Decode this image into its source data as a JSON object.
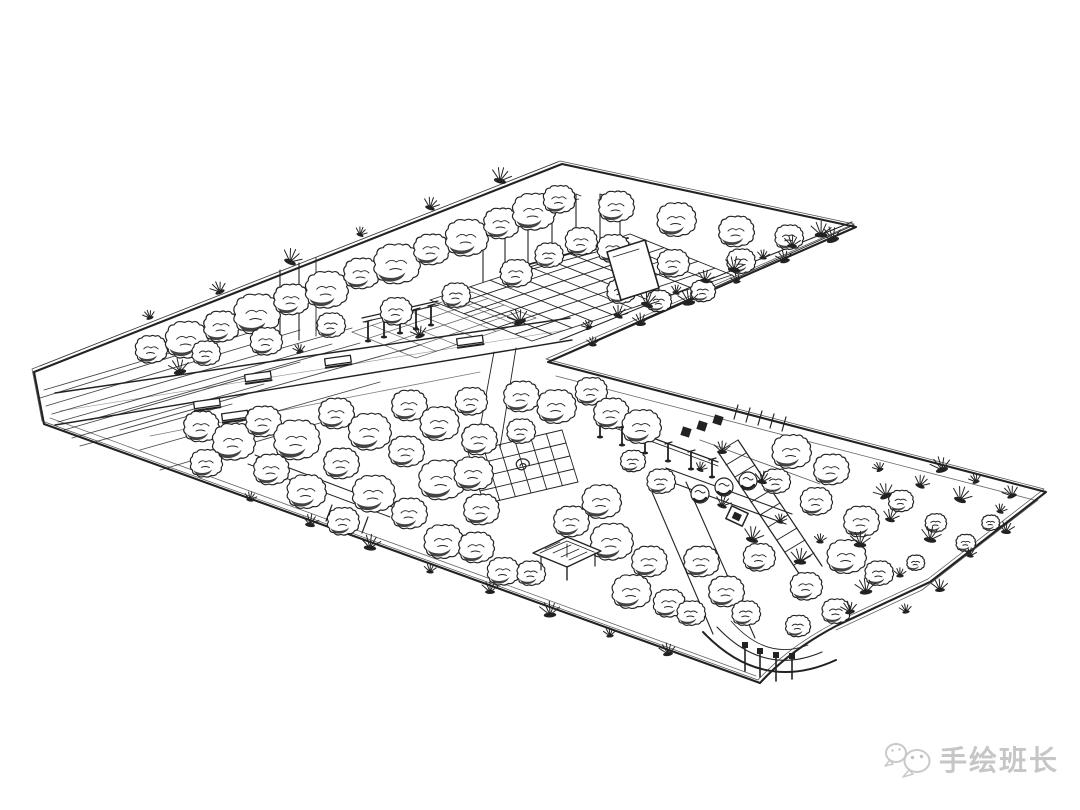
{
  "meta": {
    "title": "Hand-drawn landscape architecture aerial perspective sketch",
    "medium": "pen and ink on white paper"
  },
  "watermark": {
    "text": "手绘班长",
    "icon": "wechat-icon",
    "color": "#c6c6c6"
  },
  "colors": {
    "ink": "#222222",
    "paper": "#ffffff",
    "light": "#555555",
    "watermark": "#c6c6c6"
  },
  "sketch": {
    "boundary": {
      "d": "M34,372 L562,164 L856,227 L548,362 L1046,492 L930,582 L838,625 Q790,650 760,683 L44,424 Z",
      "offset": [
        -2,
        -3
      ]
    },
    "hatch": [
      [
        40,
        398,
        258,
        330
      ],
      [
        46,
        406,
        300,
        330
      ],
      [
        52,
        414,
        352,
        328
      ],
      [
        58,
        422,
        332,
        344
      ],
      [
        64,
        430,
        300,
        362
      ],
      [
        72,
        438,
        264,
        384
      ],
      [
        80,
        446,
        232,
        404
      ],
      [
        44,
        390,
        180,
        350
      ],
      [
        120,
        430,
        420,
        345
      ],
      [
        140,
        450,
        380,
        382
      ],
      [
        90,
        420,
        360,
        343
      ],
      [
        160,
        470,
        330,
        420
      ]
    ],
    "lines": [
      [
        55,
        393,
        570,
        318,
        1.4
      ],
      [
        55,
        425,
        572,
        340,
        1.4
      ],
      [
        60,
        411,
        566,
        330,
        0.6,
        0.5
      ],
      [
        150,
        436,
        480,
        372,
        0.8,
        0.6
      ],
      [
        560,
        340,
        852,
        222,
        1.1
      ],
      [
        570,
        352,
        854,
        225,
        0.9
      ],
      [
        556,
        376,
        1034,
        500,
        0.8,
        0.7
      ],
      [
        1038,
        500,
        922,
        590,
        0.8,
        0.7
      ],
      [
        922,
        590,
        836,
        630,
        0.8,
        0.7
      ],
      [
        50,
        418,
        756,
        676,
        0.8,
        0.7
      ],
      [
        40,
        366,
        558,
        162,
        0.7,
        0.6
      ],
      [
        255,
        455,
        395,
        508,
        1
      ],
      [
        248,
        464,
        390,
        517,
        1
      ],
      [
        332,
        505,
        326,
        521,
        1.2
      ],
      [
        344,
        509,
        338,
        525,
        1.2
      ],
      [
        356,
        513,
        350,
        529,
        1.2
      ],
      [
        368,
        517,
        362,
        533,
        1.2
      ],
      [
        494,
        352,
        476,
        450,
        0.9
      ],
      [
        516,
        348,
        500,
        448,
        0.9
      ],
      [
        652,
        492,
        713,
        634,
        1.1
      ],
      [
        686,
        482,
        755,
        638,
        1.1
      ],
      [
        596,
        417,
        718,
        462,
        1.3
      ],
      [
        596,
        421,
        718,
        466,
        0.9
      ],
      [
        666,
        468,
        792,
        514,
        1.1
      ],
      [
        660,
        478,
        786,
        524,
        1.1
      ],
      [
        700,
        440,
        820,
        484,
        0.9,
        0.7
      ],
      [
        718,
        452,
        802,
        578,
        1.2
      ],
      [
        738,
        440,
        822,
        566,
        1.2
      ],
      [
        718,
        452,
        738,
        440,
        1
      ],
      [
        726,
        465,
        746,
        453,
        1
      ],
      [
        735,
        477,
        755,
        465,
        1
      ],
      [
        743,
        490,
        763,
        478,
        1
      ],
      [
        751,
        502,
        771,
        490,
        1
      ],
      [
        760,
        515,
        780,
        503,
        1
      ],
      [
        768,
        527,
        788,
        515,
        1
      ],
      [
        777,
        540,
        797,
        528,
        1
      ],
      [
        785,
        552,
        805,
        540,
        1
      ],
      [
        794,
        565,
        814,
        553,
        1
      ],
      [
        738,
        405,
        734,
        419,
        1.2
      ],
      [
        750,
        408,
        746,
        422,
        1.2
      ],
      [
        762,
        411,
        758,
        425,
        1.2
      ],
      [
        774,
        414,
        770,
        428,
        1.2
      ],
      [
        786,
        417,
        782,
        431,
        1.2
      ],
      [
        362,
        318,
        438,
        301,
        1.2
      ],
      [
        363,
        322,
        439,
        305,
        0.9
      ],
      [
        280,
        270,
        280,
        345,
        1.1
      ],
      [
        299,
        263,
        299,
        340,
        1.1
      ],
      [
        316,
        258,
        316,
        336,
        0.9
      ],
      [
        500,
        272,
        628,
        238,
        1.8
      ],
      [
        502,
        277,
        630,
        243,
        0.9
      ]
    ],
    "grids": [
      {
        "o": [
          430,
          300
        ],
        "u": [
          200,
          -66
        ],
        "v": [
          102,
          41
        ],
        "nu": 10,
        "nv": 6,
        "w": 0.9,
        "op": 1
      },
      {
        "o": [
          352,
          332
        ],
        "u": [
          120,
          -40
        ],
        "v": [
          64,
          26
        ],
        "nu": 6,
        "nv": 4,
        "w": 0.7,
        "op": 0.7
      },
      {
        "o": [
          468,
          452
        ],
        "u": [
          94,
          -22
        ],
        "v": [
          16,
          52
        ],
        "nu": 6,
        "nv": 4,
        "w": 0.9,
        "op": 1
      }
    ],
    "poles": [
      [
        483,
        282,
        50
      ],
      [
        505,
        275,
        54
      ],
      [
        528,
        268,
        60
      ],
      [
        552,
        260,
        62
      ],
      [
        576,
        252,
        58
      ],
      [
        600,
        244,
        50
      ],
      [
        620,
        237,
        44
      ]
    ],
    "columns": [
      [
        600,
        436,
        16
      ],
      [
        622,
        444,
        16
      ],
      [
        645,
        452,
        16
      ],
      [
        668,
        460,
        16
      ],
      [
        691,
        468,
        16
      ],
      [
        712,
        476,
        16
      ],
      [
        368,
        340,
        18
      ],
      [
        384,
        336,
        18
      ],
      [
        400,
        332,
        18
      ],
      [
        416,
        328,
        18
      ],
      [
        431,
        324,
        18
      ]
    ],
    "benches": [
      [
        258,
        377,
        -8
      ],
      [
        338,
        361,
        -8
      ],
      [
        470,
        341,
        -8
      ],
      [
        207,
        404,
        -8
      ],
      [
        235,
        416,
        -8
      ]
    ],
    "squares": [
      [
        686,
        432,
        9
      ],
      [
        702,
        426,
        9
      ],
      [
        718,
        420,
        9
      ]
    ],
    "bowls": [
      [
        700,
        494
      ],
      [
        724,
        487
      ],
      [
        748,
        481
      ]
    ],
    "feature_square": [
      [
        737,
        516
      ]
    ],
    "trees": [
      [
        150,
        348,
        0.9
      ],
      [
        185,
        338,
        1.2
      ],
      [
        220,
        325,
        1.0
      ],
      [
        255,
        312,
        1.3
      ],
      [
        290,
        298,
        1.0
      ],
      [
        325,
        288,
        1.2
      ],
      [
        360,
        272,
        1.0
      ],
      [
        395,
        262,
        1.3
      ],
      [
        430,
        248,
        1.0
      ],
      [
        465,
        236,
        1.2
      ],
      [
        500,
        222,
        1.0
      ],
      [
        532,
        210,
        1.2
      ],
      [
        558,
        198,
        0.9
      ],
      [
        205,
        352,
        0.8
      ],
      [
        265,
        340,
        0.9
      ],
      [
        330,
        324,
        0.8
      ],
      [
        395,
        310,
        0.9
      ],
      [
        455,
        294,
        0.8
      ],
      [
        515,
        272,
        0.9
      ],
      [
        548,
        254,
        0.8
      ],
      [
        580,
        240,
        0.9
      ],
      [
        615,
        205,
        1.0
      ],
      [
        612,
        247,
        0.9
      ],
      [
        620,
        290,
        0.8
      ],
      [
        675,
        218,
        1.1
      ],
      [
        672,
        262,
        0.9
      ],
      [
        735,
        230,
        1.0
      ],
      [
        740,
        260,
        0.8
      ],
      [
        788,
        236,
        0.8
      ],
      [
        658,
        300,
        0.7
      ],
      [
        702,
        290,
        0.7
      ],
      [
        200,
        425,
        1.0
      ],
      [
        232,
        440,
        1.2
      ],
      [
        205,
        462,
        0.9
      ],
      [
        262,
        420,
        1.0
      ],
      [
        295,
        438,
        1.3
      ],
      [
        270,
        468,
        1.0
      ],
      [
        305,
        490,
        1.1
      ],
      [
        335,
        412,
        1.0
      ],
      [
        368,
        430,
        1.2
      ],
      [
        340,
        462,
        1.0
      ],
      [
        372,
        492,
        1.2
      ],
      [
        342,
        520,
        0.9
      ],
      [
        408,
        404,
        1.0
      ],
      [
        438,
        422,
        1.1
      ],
      [
        405,
        450,
        1.0
      ],
      [
        440,
        478,
        1.3
      ],
      [
        408,
        512,
        1.0
      ],
      [
        442,
        540,
        1.1
      ],
      [
        470,
        400,
        0.9
      ],
      [
        478,
        438,
        1.0
      ],
      [
        472,
        472,
        1.1
      ],
      [
        480,
        508,
        1.0
      ],
      [
        475,
        546,
        1.0
      ],
      [
        502,
        570,
        0.9
      ],
      [
        520,
        395,
        1.0
      ],
      [
        555,
        405,
        1.1
      ],
      [
        590,
        390,
        0.9
      ],
      [
        520,
        430,
        0.8
      ],
      [
        610,
        412,
        1.0
      ],
      [
        640,
        425,
        1.1
      ],
      [
        600,
        500,
        1.1
      ],
      [
        570,
        520,
        1.0
      ],
      [
        530,
        572,
        0.8
      ],
      [
        610,
        540,
        1.2
      ],
      [
        648,
        560,
        1.0
      ],
      [
        630,
        590,
        1.1
      ],
      [
        668,
        602,
        0.9
      ],
      [
        700,
        560,
        1.0
      ],
      [
        690,
        612,
        0.8
      ],
      [
        725,
        590,
        1.0
      ],
      [
        660,
        480,
        0.8
      ],
      [
        632,
        460,
        0.7
      ],
      [
        758,
        556,
        0.9
      ],
      [
        745,
        612,
        0.8
      ],
      [
        790,
        450,
        1.1
      ],
      [
        830,
        468,
        1.0
      ],
      [
        815,
        500,
        0.9
      ],
      [
        860,
        520,
        1.0
      ],
      [
        845,
        555,
        1.1
      ],
      [
        878,
        572,
        0.8
      ],
      [
        805,
        585,
        0.9
      ],
      [
        835,
        610,
        0.8
      ],
      [
        797,
        625,
        0.7
      ],
      [
        775,
        480,
        0.8
      ],
      [
        900,
        500,
        0.7
      ],
      [
        935,
        522,
        0.6
      ],
      [
        965,
        542,
        0.55
      ],
      [
        915,
        562,
        0.5
      ],
      [
        990,
        522,
        0.5
      ]
    ],
    "tufts": [
      [
        589,
        328
      ],
      [
        618,
        316
      ],
      [
        647,
        305
      ],
      [
        676,
        293
      ],
      [
        705,
        281
      ],
      [
        734,
        270
      ],
      [
        763,
        258
      ],
      [
        792,
        246
      ],
      [
        821,
        235
      ],
      [
        593,
        345
      ],
      [
        641,
        324
      ],
      [
        689,
        303
      ],
      [
        737,
        282
      ],
      [
        785,
        261
      ],
      [
        833,
        240
      ],
      [
        150,
        318
      ],
      [
        220,
        292
      ],
      [
        290,
        262
      ],
      [
        360,
        235
      ],
      [
        430,
        208
      ],
      [
        500,
        181
      ],
      [
        250,
        500
      ],
      [
        310,
        525
      ],
      [
        370,
        548
      ],
      [
        430,
        572
      ],
      [
        490,
        592
      ],
      [
        550,
        615
      ],
      [
        610,
        636
      ],
      [
        668,
        654
      ],
      [
        180,
        372
      ],
      [
        300,
        352
      ],
      [
        420,
        336
      ],
      [
        520,
        322
      ],
      [
        880,
        470
      ],
      [
        920,
        486
      ],
      [
        960,
        500
      ],
      [
        1000,
        512
      ],
      [
        890,
        520
      ],
      [
        930,
        540
      ],
      [
        970,
        556
      ],
      [
        1006,
        532
      ],
      [
        860,
        545
      ],
      [
        900,
        576
      ],
      [
        940,
        590
      ],
      [
        866,
        592
      ],
      [
        906,
        612
      ],
      [
        850,
        612
      ],
      [
        942,
        470
      ],
      [
        976,
        482
      ],
      [
        1012,
        496
      ],
      [
        886,
        496
      ],
      [
        700,
        470
      ],
      [
        722,
        506
      ],
      [
        752,
        540
      ],
      [
        780,
        522
      ],
      [
        762,
        482
      ],
      [
        800,
        562
      ],
      [
        820,
        542
      ],
      [
        722,
        452
      ]
    ],
    "features": {
      "paths": [
        {
          "d": "M703,632 Q762,694 836,660",
          "w": 2
        },
        {
          "d": "M717,627 Q764,677 822,652",
          "w": 1.1
        },
        {
          "d": "M731,621 Q766,661 808,645",
          "w": 0.8
        },
        {
          "d": "M520,466 a3,2.4 0 1 1 6,0 a4.5,3.6 0 1 1 -9,0.5 a6.5,5.2 0 1 1 12,-1",
          "w": 1.2
        },
        {
          "d": "M533,553 L567,537 L601,551 L567,567 Z",
          "w": 1.4,
          "f": "#ffffff"
        },
        {
          "d": "M540,553 L567,541 L594,552",
          "w": 0.8
        },
        {
          "d": "M607,252 L645,240 L659,288 L621,300 Z",
          "w": 1.6,
          "f": "#ffffff"
        },
        {
          "d": "M613,257 L639,249",
          "w": 0.8
        }
      ],
      "lines": [
        [
          541,
          557,
          541,
          570,
          1.2
        ],
        [
          567,
          544,
          567,
          557,
          0.9
        ],
        [
          595,
          553,
          595,
          566,
          1.2
        ],
        [
          567,
          567,
          567,
          580,
          1.4
        ],
        [
          545,
          549,
          560,
          542,
          0.7
        ],
        [
          553,
          553,
          571,
          545,
          0.7
        ],
        [
          561,
          557,
          579,
          549,
          0.7
        ],
        [
          569,
          560,
          587,
          552,
          0.7
        ],
        [
          745,
          646,
          745,
          671,
          1.6
        ],
        [
          760,
          652,
          760,
          677,
          1.6
        ],
        [
          776,
          656,
          776,
          681,
          1.6
        ],
        [
          792,
          657,
          792,
          679,
          1.6
        ]
      ],
      "squares": [
        [
          745,
          645,
          6
        ],
        [
          760,
          651,
          6
        ],
        [
          776,
          655,
          6
        ],
        [
          792,
          656,
          6
        ]
      ]
    }
  }
}
